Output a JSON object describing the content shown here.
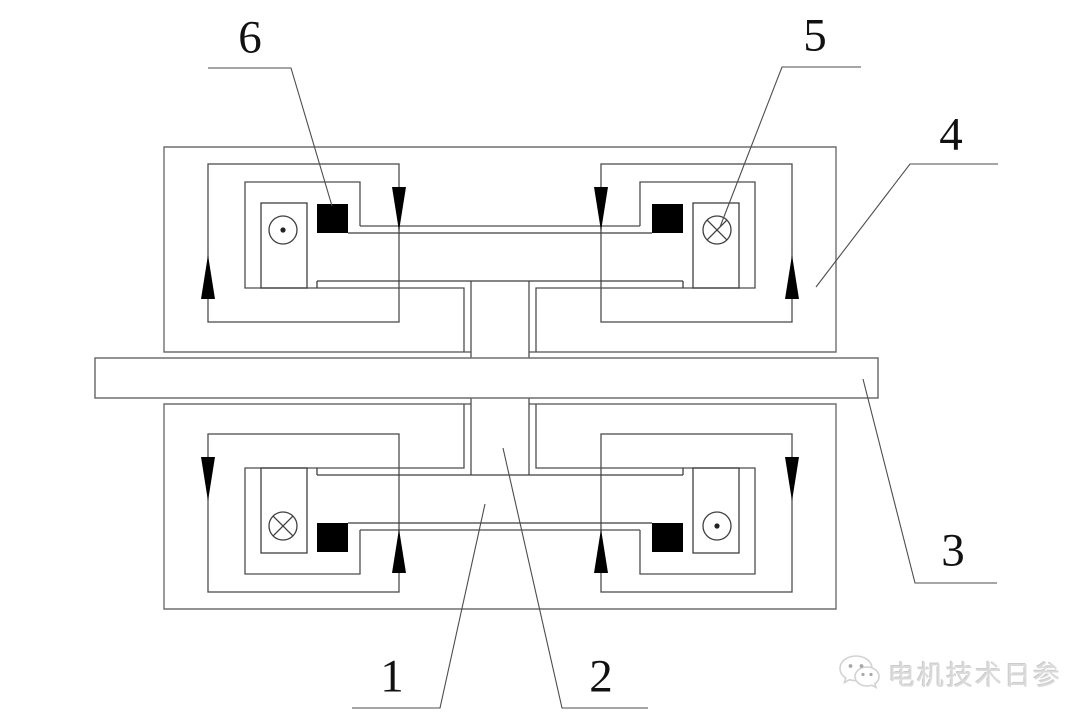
{
  "diagram": {
    "type": "engineering-cross-section",
    "part_labels": [
      {
        "id": "label-1",
        "text": "1"
      },
      {
        "id": "label-2",
        "text": "2"
      },
      {
        "id": "label-3",
        "text": "3"
      },
      {
        "id": "label-4",
        "text": "4"
      },
      {
        "id": "label-5",
        "text": "5"
      },
      {
        "id": "label-6",
        "text": "6"
      }
    ],
    "symbols": {
      "current_out_icon": "circle-dot-icon",
      "current_in_icon": "circle-cross-icon",
      "magnet_block": "solid-black-square",
      "flux_arrow": "solid-triangle-arrow"
    },
    "watermark": {
      "icon": "wechat-logo-icon",
      "text": "电机技术日参"
    },
    "colors": {
      "background": "#ffffff",
      "line": "#4d4d4d",
      "solid_black": "#000000",
      "watermark_gray": "#dadada"
    }
  }
}
